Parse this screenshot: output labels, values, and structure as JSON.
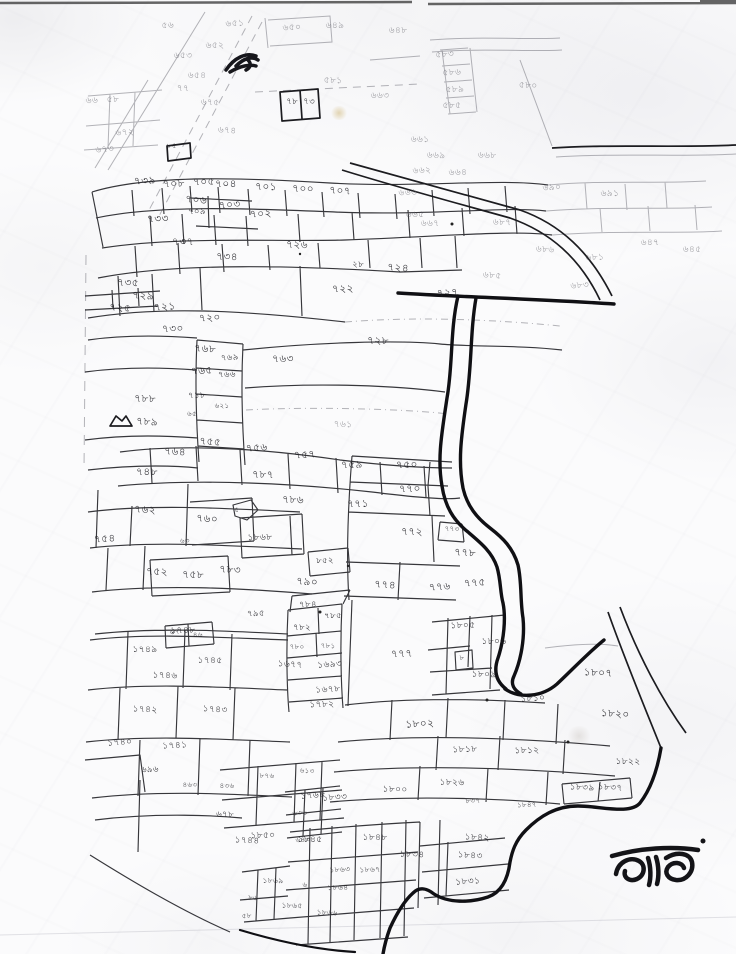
{
  "colors": {
    "ink": "#1c1c22",
    "ink_faint": "#5a5a62",
    "paper": "#fbfbfc"
  },
  "annotation": {
    "text": "ভাড"
  },
  "labels": [
    [
      168,
      28,
      "৫৬",
      "f"
    ],
    [
      235,
      26,
      "৬৫১",
      "f"
    ],
    [
      292,
      30,
      "৬৫০",
      "f"
    ],
    [
      215,
      48,
      "৬৫২",
      "f"
    ],
    [
      183,
      58,
      "৬৫৩",
      "f"
    ],
    [
      197,
      78,
      "৬৫৪",
      "f"
    ],
    [
      183,
      91,
      "৭৭",
      "f"
    ],
    [
      210,
      105,
      "৬৭৫",
      "f"
    ],
    [
      227,
      133,
      "৬৭৪",
      "f"
    ],
    [
      105,
      152,
      "৬৭৩",
      "f"
    ],
    [
      125,
      135,
      "৬৭২",
      "f"
    ],
    [
      92,
      103,
      "৬৬",
      "f"
    ],
    [
      113,
      102,
      "৫৮",
      "f"
    ],
    [
      335,
      28,
      "৬৪৯",
      "f"
    ],
    [
      398,
      33,
      "৬৪৮",
      "f"
    ],
    [
      333,
      83,
      "৫৮১",
      "f"
    ],
    [
      292,
      104,
      "৭৮",
      "s"
    ],
    [
      309,
      104,
      "৭৩",
      "s"
    ],
    [
      445,
      57,
      "৫৮৩",
      "f"
    ],
    [
      452,
      75,
      "৫৮৬",
      "f"
    ],
    [
      455,
      92,
      "৫৮৯",
      "f"
    ],
    [
      452,
      108,
      "৫৮৫",
      "f"
    ],
    [
      380,
      98,
      "৬৬৩",
      "f"
    ],
    [
      420,
      142,
      "৬৬১",
      "f"
    ],
    [
      436,
      158,
      "৬৬৯",
      "f"
    ],
    [
      487,
      158,
      "৬৬৮",
      "f"
    ],
    [
      528,
      88,
      "৫৮০",
      "f"
    ],
    [
      172,
      148,
      "৮৫",
      "t"
    ],
    [
      145,
      184,
      "৭৩৯",
      ""
    ],
    [
      174,
      187,
      "৭০৮",
      ""
    ],
    [
      204,
      185,
      "৭০৫",
      ""
    ],
    [
      226,
      187,
      "৭০৪",
      ""
    ],
    [
      266,
      190,
      "৭০১",
      ""
    ],
    [
      303,
      192,
      "৭০০",
      ""
    ],
    [
      340,
      194,
      "৭০৭",
      ""
    ],
    [
      196,
      203,
      "৭০৬",
      ""
    ],
    [
      230,
      208,
      "৭০৩",
      ""
    ],
    [
      261,
      217,
      "৭০২",
      ""
    ],
    [
      197,
      214,
      "৭০৯",
      "s"
    ],
    [
      158,
      222,
      "৭৩৩",
      ""
    ],
    [
      183,
      245,
      "৭৩৭",
      ""
    ],
    [
      297,
      248,
      "৭২৬",
      ""
    ],
    [
      227,
      260,
      "৭৩৪",
      ""
    ],
    [
      358,
      267,
      "২৮",
      "s"
    ],
    [
      398,
      271,
      "৭২৪",
      ""
    ],
    [
      448,
      296,
      "৭২৭",
      ""
    ],
    [
      408,
      195,
      "৬৬৬",
      "f"
    ],
    [
      422,
      173,
      "৬৬২",
      "f"
    ],
    [
      458,
      175,
      "৬৬৪",
      "f"
    ],
    [
      415,
      217,
      "৬৬৫",
      "f"
    ],
    [
      430,
      226,
      "৬৬৭",
      "f"
    ],
    [
      502,
      225,
      "৬৮৭",
      "f"
    ],
    [
      545,
      252,
      "৬৮৬",
      "f"
    ],
    [
      492,
      278,
      "৬৮৫",
      "f"
    ],
    [
      580,
      288,
      "৬৮৩",
      "f"
    ],
    [
      595,
      260,
      "৬৮১",
      "f"
    ],
    [
      552,
      190,
      "৬৯০",
      "f"
    ],
    [
      610,
      196,
      "৬৯১",
      "f"
    ],
    [
      650,
      245,
      "৬৪৭",
      "f"
    ],
    [
      692,
      252,
      "৬৪৫",
      "f"
    ],
    [
      128,
      286,
      "৭৩৫",
      ""
    ],
    [
      143,
      299,
      "৭২৯",
      ""
    ],
    [
      120,
      311,
      "৭২৫",
      ""
    ],
    [
      165,
      310,
      "৭২১",
      ""
    ],
    [
      210,
      321,
      "৭২০",
      ""
    ],
    [
      173,
      332,
      "৭৩০",
      ""
    ],
    [
      343,
      292,
      "৭২২",
      ""
    ],
    [
      283,
      362,
      "৭৬৩",
      ""
    ],
    [
      378,
      344,
      "৭২৮",
      ""
    ],
    [
      145,
      402,
      "৭৮৮",
      ""
    ],
    [
      147,
      425,
      "৭৮৯",
      ""
    ],
    [
      205,
      352,
      "৭৬৮",
      ""
    ],
    [
      230,
      360,
      "৭৬৯",
      "s"
    ],
    [
      202,
      374,
      "৭৬৫",
      ""
    ],
    [
      227,
      377,
      "৭৬৬",
      "s"
    ],
    [
      197,
      398,
      "৭১৮",
      "s"
    ],
    [
      222,
      408,
      "৬২১",
      "t"
    ],
    [
      192,
      416,
      "৬৫",
      "t"
    ],
    [
      343,
      427,
      "৭৬১",
      "f"
    ],
    [
      175,
      455,
      "৭৬৪",
      ""
    ],
    [
      210,
      445,
      "৭৫৫",
      ""
    ],
    [
      257,
      451,
      "৭৫৬",
      ""
    ],
    [
      305,
      458,
      "৭৫৭",
      ""
    ],
    [
      352,
      468,
      "৭৫৯",
      ""
    ],
    [
      407,
      468,
      "৭৫০",
      ""
    ],
    [
      147,
      475,
      "৭৪৮",
      ""
    ],
    [
      263,
      478,
      "৭৮৭",
      ""
    ],
    [
      293,
      503,
      "৭৮৬",
      ""
    ],
    [
      145,
      513,
      "৭৬২",
      ""
    ],
    [
      207,
      522,
      "৭৬০",
      ""
    ],
    [
      237,
      512,
      "৫",
      "t"
    ],
    [
      105,
      542,
      "৭৫৪",
      ""
    ],
    [
      185,
      543,
      "৬৩",
      "t"
    ],
    [
      260,
      540,
      "১৮৬৮",
      "q"
    ],
    [
      325,
      563,
      "৮৫২",
      "s"
    ],
    [
      157,
      575,
      "৭৫২",
      ""
    ],
    [
      193,
      578,
      "৭৫৮",
      ""
    ],
    [
      230,
      573,
      "৭৮৩",
      ""
    ],
    [
      307,
      585,
      "৭৯০",
      ""
    ],
    [
      175,
      634,
      "৬৭",
      "t"
    ],
    [
      198,
      637,
      "৪৬",
      "t"
    ],
    [
      256,
      616,
      "৭৯৫",
      "s"
    ],
    [
      410,
      492,
      "৭৭০",
      ""
    ],
    [
      358,
      507,
      "৭৭১",
      ""
    ],
    [
      412,
      535,
      "৭৭২",
      ""
    ],
    [
      452,
      531,
      "৭৭৩",
      "t"
    ],
    [
      465,
      556,
      "৭৭৮",
      ""
    ],
    [
      385,
      588,
      "৭৭৪",
      ""
    ],
    [
      440,
      590,
      "৭৭৬",
      ""
    ],
    [
      475,
      586,
      "৭৭৫",
      ""
    ],
    [
      402,
      657,
      "৭৭৭",
      ""
    ],
    [
      308,
      607,
      "৭৮৪",
      "s"
    ],
    [
      333,
      618,
      "৭৮৫",
      "s"
    ],
    [
      302,
      630,
      "৭৮২",
      "s"
    ],
    [
      297,
      649,
      "৭৮০",
      "t"
    ],
    [
      328,
      648,
      "৭৮১",
      "t"
    ],
    [
      290,
      667,
      "১৬৭৭",
      "q"
    ],
    [
      330,
      667,
      "১৬৯৩",
      "q"
    ],
    [
      328,
      692,
      "১৬৭৮",
      "q"
    ],
    [
      322,
      707,
      "১৭৮২",
      "q"
    ],
    [
      183,
      633,
      "১৭৪৮",
      "q"
    ],
    [
      145,
      652,
      "১৭৪৯",
      "q"
    ],
    [
      210,
      663,
      "১৭৪৫",
      "q"
    ],
    [
      165,
      678,
      "১৭৪৬",
      "q"
    ],
    [
      145,
      712,
      "১৭৪২",
      "q"
    ],
    [
      215,
      712,
      "১৭৪৩",
      "q"
    ],
    [
      120,
      745,
      "১৭৪০",
      "q"
    ],
    [
      175,
      748,
      "১৭৪১",
      "q"
    ],
    [
      150,
      772,
      "৬৯৬",
      "s"
    ],
    [
      190,
      787,
      "৪৬৩",
      "t"
    ],
    [
      227,
      788,
      "৪৩৬",
      "t"
    ],
    [
      267,
      778,
      "৮৭৬",
      "t"
    ],
    [
      225,
      817,
      "৬৭৮",
      "s"
    ],
    [
      247,
      843,
      "১৭৪৪",
      "q"
    ],
    [
      307,
      773,
      "৬১৩",
      "t"
    ],
    [
      313,
      798,
      "১৭৬৮",
      "q"
    ],
    [
      300,
      815,
      "৬৩৬",
      "t"
    ],
    [
      303,
      842,
      "৬৪৩",
      "t"
    ],
    [
      463,
      628,
      "১৮০৫",
      "q"
    ],
    [
      494,
      644,
      "১৮০৬",
      "q"
    ],
    [
      462,
      660,
      "৮",
      "t"
    ],
    [
      484,
      677,
      "১৮০৯",
      "q"
    ],
    [
      598,
      676,
      "১৮০৭",
      "Q"
    ],
    [
      615,
      717,
      "১৮২০",
      "Q"
    ],
    [
      533,
      701,
      "১৮১০",
      "q"
    ],
    [
      420,
      727,
      "১৮০২",
      "Q"
    ],
    [
      465,
      752,
      "১৮১৮",
      "q"
    ],
    [
      527,
      753,
      "১৮১২",
      "q"
    ],
    [
      628,
      764,
      "১৮২২",
      "q"
    ],
    [
      452,
      785,
      "১৮২৬",
      "q"
    ],
    [
      395,
      792,
      "১৮০০",
      "q"
    ],
    [
      582,
      790,
      "১৮৩৯",
      "q"
    ],
    [
      610,
      790,
      "১৮৩৭",
      "q"
    ],
    [
      335,
      800,
      "১৮৩৩",
      "q"
    ],
    [
      473,
      803,
      "৮৩৭",
      "t"
    ],
    [
      527,
      807,
      "১৮৪৭",
      "t"
    ],
    [
      263,
      838,
      "১৮৫০",
      "q"
    ],
    [
      310,
      842,
      "১৮৪৫",
      "q"
    ],
    [
      375,
      840,
      "১৮৪৮",
      "q"
    ],
    [
      412,
      857,
      "১৮৩৪",
      "q"
    ],
    [
      477,
      840,
      "১৮৪২",
      "q"
    ],
    [
      470,
      858,
      "১৮৪৩",
      "q"
    ],
    [
      468,
      884,
      "১৮৩১",
      "q"
    ],
    [
      340,
      872,
      "১৮৬৩",
      "u"
    ],
    [
      370,
      872,
      "১৮৬৭",
      "u"
    ],
    [
      338,
      890,
      "১৮৬৪",
      "u"
    ],
    [
      305,
      887,
      "৬",
      "t"
    ],
    [
      273,
      883,
      "১৮৬৯",
      "u"
    ],
    [
      292,
      908,
      "১৮৬৫",
      "u"
    ],
    [
      327,
      915,
      "১৮৬৬",
      "u"
    ],
    [
      253,
      900,
      "৮৬",
      "t"
    ],
    [
      247,
      918,
      "৫৮",
      "t"
    ]
  ]
}
